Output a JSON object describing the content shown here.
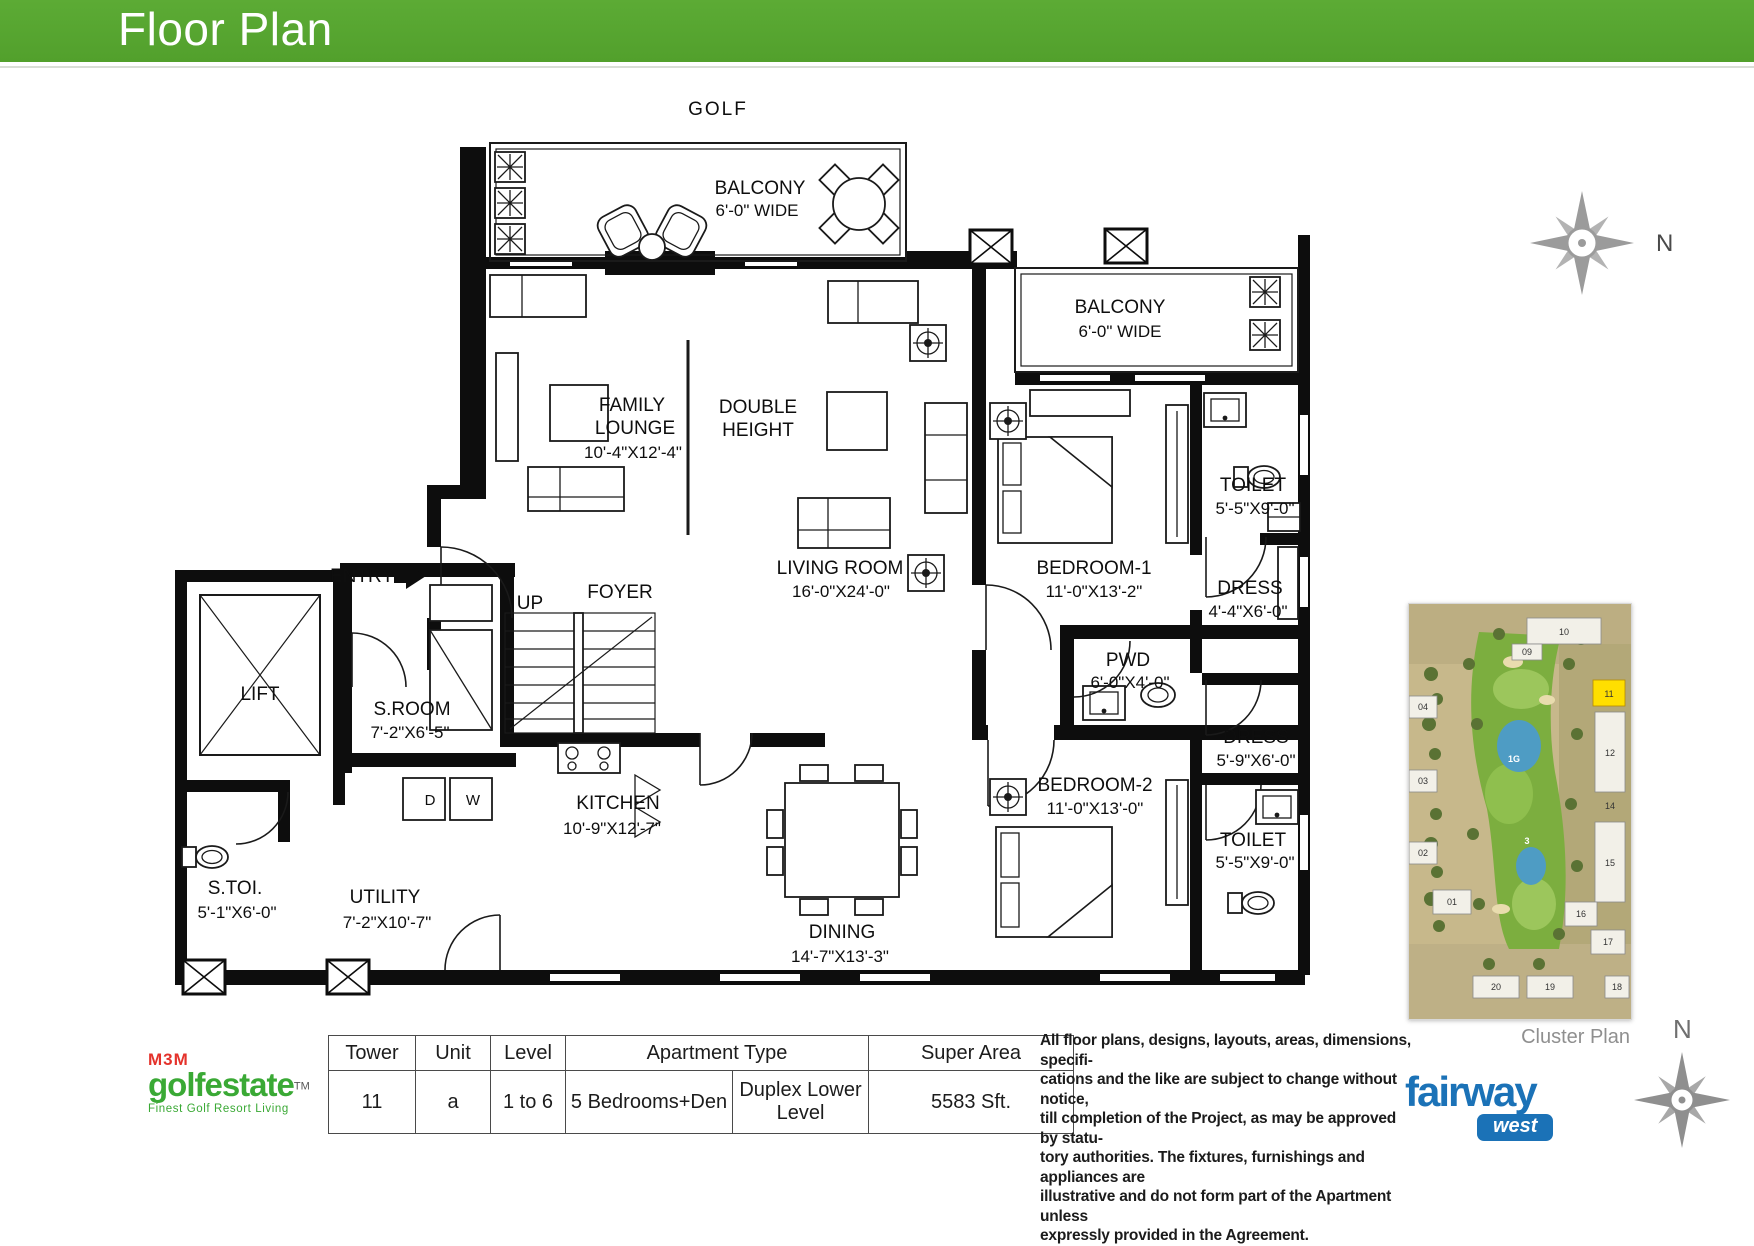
{
  "colors": {
    "header_green": "#55a62f",
    "m3m_green": "#3aa935",
    "m3m_red": "#e4322b",
    "fairway_blue": "#1b72b7",
    "cluster_highlight": "#ffdf00",
    "compass_gray": "#9b9b9b"
  },
  "header": {
    "title": "Floor Plan"
  },
  "compass": {
    "label": "N"
  },
  "plan": {
    "golf": "GOLF",
    "balcony_top": {
      "l1": "BALCONY",
      "l2": "6'-0\" WIDE"
    },
    "balcony_right": {
      "l1": "BALCONY",
      "l2": "6'-0\" WIDE"
    },
    "family_lounge": {
      "l1": "FAMILY",
      "l2": "LOUNGE",
      "dim": "10'-4\"X12'-4\""
    },
    "double_height": {
      "l1": "DOUBLE",
      "l2": "HEIGHT"
    },
    "living_room": {
      "l1": "LIVING ROOM",
      "dim": "16'-0\"X24'-0\""
    },
    "bedroom1": {
      "l1": "BEDROOM-1",
      "dim": "11'-0\"X13'-2\""
    },
    "toilet1": {
      "l1": "TOILET",
      "dim": "5'-5\"X9'-0\""
    },
    "dress1": {
      "l1": "DRESS",
      "dim": "4'-4\"X6'-0\""
    },
    "pwd": {
      "l1": "PWD",
      "dim": "6'-0\"X4'-0\""
    },
    "bedroom2": {
      "l1": "BEDROOM-2",
      "dim": "11'-0\"X13'-0\""
    },
    "dress2": {
      "l1": "DRESS",
      "dim": "5'-9\"X6'-0\""
    },
    "toilet2": {
      "l1": "TOILET",
      "dim": "5'-5\"X9'-0\""
    },
    "entry": "ENTRY",
    "up": "UP",
    "foyer": "FOYER",
    "lift": "LIFT",
    "sroom": {
      "l1": "S.ROOM",
      "dim": "7'-2\"X6'-5\""
    },
    "stoi": {
      "l1": "S.TOI.",
      "dim": "5'-1\"X6'-0\""
    },
    "kitchen": {
      "l1": "KITCHEN",
      "dim": "10'-9\"X12'-7\""
    },
    "utility": {
      "l1": "UTILITY",
      "dim": "7'-2\"X10'-7\""
    },
    "dining": {
      "l1": "DINING",
      "dim": "14'-7\"X13'-3\""
    },
    "dryer": "D",
    "washer": "W"
  },
  "cluster": {
    "caption": "Cluster Plan",
    "n01": "01",
    "n02": "02",
    "n03": "03",
    "n04": "04",
    "n09": "09",
    "n10": "10",
    "n11": "11",
    "n12": "12",
    "n14": "14",
    "n15": "15",
    "n16": "16",
    "n17": "17",
    "n18": "18",
    "n19": "19",
    "n20": "20",
    "g1": "1G",
    "g3": "3"
  },
  "table": {
    "headers": {
      "tower": "Tower",
      "unit": "Unit",
      "level": "Level",
      "apartment_type": "Apartment Type",
      "super_area": "Super Area"
    },
    "row": {
      "tower": "11",
      "unit": "a",
      "level": "1 to 6",
      "type_main": "5 Bedrooms+Den",
      "type_sub": "Duplex Lower Level",
      "super_area": "5583 Sft."
    }
  },
  "disclaimer": {
    "l1": "All floor plans, designs, layouts, areas, dimensions, specifi-",
    "l2": "cations and the like are subject to change without notice,",
    "l3": "till completion of the Project, as may be approved by statu-",
    "l4": "tory authorities. The fixtures, furnishings and appliances are",
    "l5": "illustrative and do not form part of the Apartment unless",
    "l6": "expressly provided in the Agreement."
  },
  "logos": {
    "m3m": {
      "brand": "M3M",
      "name": "golfestate",
      "tm": "TM",
      "tagline": "Finest Golf Resort Living"
    },
    "fairway": {
      "name": "fairway",
      "sub": "west"
    }
  }
}
